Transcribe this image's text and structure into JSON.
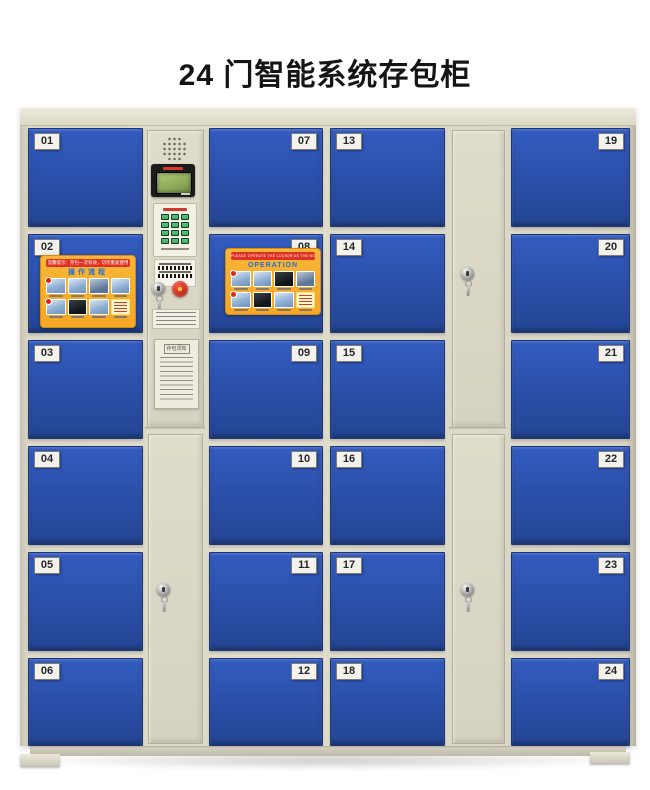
{
  "page": {
    "title": "24 门智能系统存包柜"
  },
  "door_numbers": [
    "01",
    "02",
    "03",
    "04",
    "05",
    "06",
    "07",
    "08",
    "09",
    "10",
    "11",
    "12",
    "13",
    "14",
    "15",
    "16",
    "17",
    "18",
    "19",
    "20",
    "21",
    "22",
    "23",
    "24"
  ],
  "stickers": {
    "door02": {
      "banner": "温馨提示：存包一次有效，切勿重复使用",
      "title": "操作流程"
    },
    "door08": {
      "banner": "PLEASE OPERATE THE LOCKER AS THE NOTICE IN A PICTURE",
      "title": "OPERATION"
    }
  },
  "control_panel": {
    "notice_title": "存包须知"
  },
  "colors": {
    "door_blue": "#2b4fa8",
    "cabinet_beige": "#dbd7c6",
    "sticker_orange": "#f6a725",
    "banner_red": "#e03224",
    "keypad_green": "#3fae62",
    "lcd_green": "#8fad5a",
    "emergency_red": "#cf2c1c"
  }
}
